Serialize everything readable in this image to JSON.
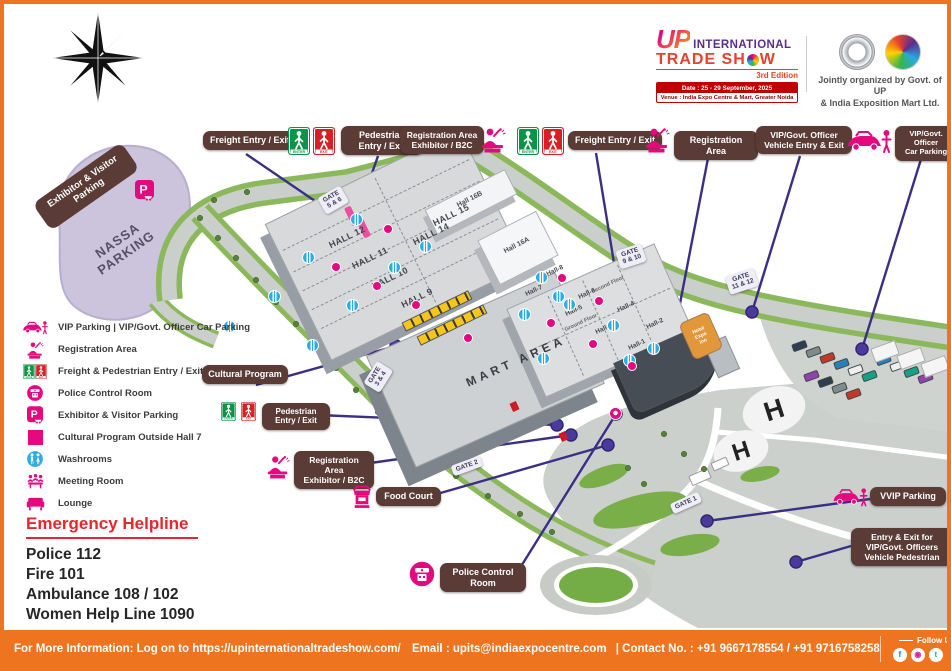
{
  "header": {
    "logo": {
      "up": "UP",
      "line1": "INTERNATIONAL",
      "trade_part1": "TRADE SH",
      "trade_part2": "W",
      "edition": "3rd Edition",
      "date": "Date : 25 - 29 September, 2025",
      "venue": "Venue : India Expo Centre & Mart, Greater Noida"
    },
    "organizer_line1": "Jointly organized by Govt. of UP",
    "organizer_line2": "& India Exposition Mart Ltd."
  },
  "callouts": {
    "freight_top_left": "Freight Entry / Exit",
    "pedestrian_top": "Pedestrian\nEntry / Exit",
    "registration_b2c_top": "Registration Area\nExhibitor / B2C",
    "freight_top_right": "Freight Entry / Exit",
    "registration_area": "Registration Area",
    "vip_vehicle": "VIP/Govt. Officer\nVehicle Entry & Exit",
    "vip_car_parking": "VIP/Govt. Officer\nCar Parking",
    "exhibitor_visitor_parking": "Exhibitor & Visitor\nParking",
    "cultural_program": "Cultural Program",
    "pedestrian_left": "Pedestrian\nEntry / Exit",
    "registration_b2c_left": "Registration Area\nExhibitor / B2C",
    "food_court": "Food Court",
    "police_control_room": "Police Control\nRoom",
    "vvip_parking": "VVIP Parking",
    "vip_entry_exit": "Entry & Exit for\nVIP/Govt. Officers\nVehicle Pedestrian"
  },
  "legend": [
    {
      "icon": "vip-parking-icon",
      "label": "VIP Parking | VIP/Govt. Officer Car Parking"
    },
    {
      "icon": "registration-icon",
      "label": "Registration Area"
    },
    {
      "icon": "enter-exit-icon",
      "label": "Freight & Pedestrian Entry / Exit"
    },
    {
      "icon": "police-icon",
      "label": "Police Control Room"
    },
    {
      "icon": "exhibitor-parking-icon",
      "label": "Exhibitor & Visitor Parking"
    },
    {
      "icon": "cultural-square-icon",
      "label": "Cultural Program Outside Hall 7"
    },
    {
      "icon": "washroom-icon",
      "label": "Washrooms"
    },
    {
      "icon": "meeting-icon",
      "label": "Meeting Room"
    },
    {
      "icon": "lounge-icon",
      "label": "Lounge"
    }
  ],
  "emergency": {
    "title": "Emergency Helpline",
    "lines": [
      "Police 112",
      "Fire 101",
      "Ambulance 108 / 102",
      "Women Help Line 1090"
    ]
  },
  "map": {
    "gates": [
      "GATE\n5 & 6",
      "GATE\n9 & 10",
      "GATE\n11 & 12",
      "GATE\n3 & 4",
      "GATE 2",
      "GATE 1"
    ],
    "halls_left": [
      "HALL 12",
      "HALL 11",
      "HALL 10",
      "HALL 9",
      "HALL 14",
      "HALL 15"
    ],
    "halls_annex": [
      "Hall 16B",
      "Hall 16A"
    ],
    "halls_right": [
      "Hall-8",
      "Hall-7",
      "Hall-6",
      "Hall-5",
      "Hall-4",
      "Hall-3",
      "Hall-2",
      "Hall-1"
    ],
    "floor_labels": [
      "Second Floor",
      "Ground Floor"
    ],
    "area_labels": {
      "mart": "MART AREA",
      "parking_name": "NASSA\nPARKING",
      "hotel": "Hotel\nExpo\nInn",
      "helipad": "H"
    }
  },
  "footer": {
    "info": "For More Information: Log on to https://upinternationaltradeshow.com/",
    "email": "Email : upits@indiaexpocentre.com",
    "contact": "| Contact No. : +91 9667178554 / +91 9716758258",
    "follow_us": "Follow Us",
    "socials": [
      "facebook",
      "instagram",
      "twitter",
      "linkedin",
      "youtube"
    ]
  },
  "colors": {
    "accent_orange": "#ee7420",
    "callout_brown": "#5a3b35",
    "leader_purple": "#3a2f85",
    "brand_pink": "#e5097f",
    "emergency_red": "#e8262d",
    "washroom_blue": "#2bace2",
    "enter_green": "#0a9447",
    "exit_red": "#d81f26"
  }
}
